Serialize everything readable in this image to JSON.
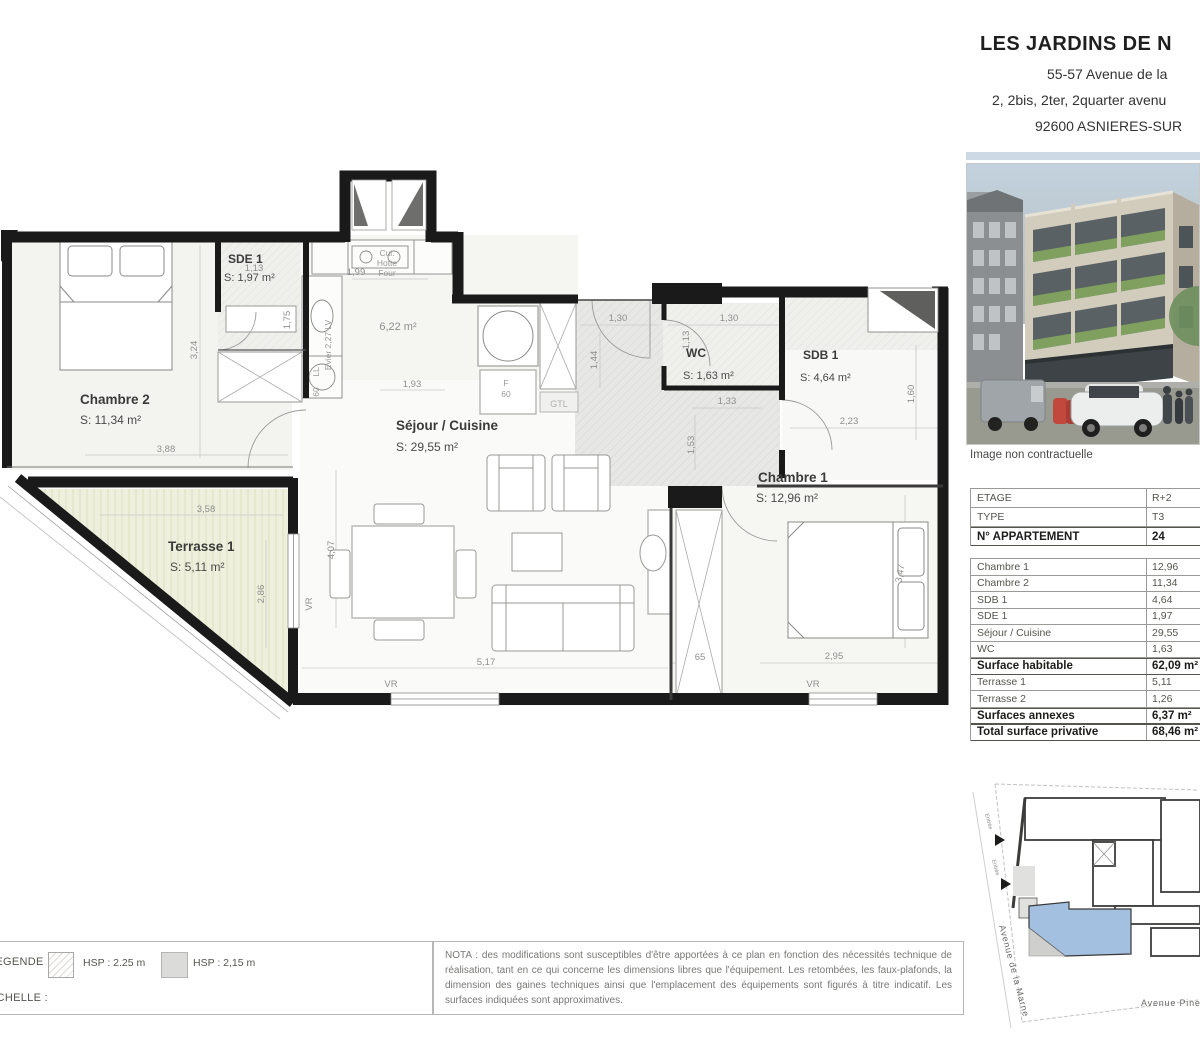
{
  "header": {
    "title": "LES JARDINS DE N",
    "line1": "55-57 Avenue de la",
    "line2": "2, 2bis, 2ter, 2quarter avenu",
    "line3": "92600 ASNIERES-SUR"
  },
  "photo": {
    "caption": "Image non contractuelle"
  },
  "table": {
    "rows": [
      {
        "label": "ETAGE",
        "value": "R+2"
      },
      {
        "label": "TYPE",
        "value": "T3"
      },
      {
        "label": "N° APPARTEMENT",
        "value": "24"
      },
      {
        "label": "Chambre 1",
        "value": "12,96"
      },
      {
        "label": "Chambre 2",
        "value": "11,34"
      },
      {
        "label": "SDB 1",
        "value": "4,64"
      },
      {
        "label": "SDE 1",
        "value": "1,97"
      },
      {
        "label": "Séjour / Cuisine",
        "value": "29,55"
      },
      {
        "label": "WC",
        "value": "1,63"
      },
      {
        "label": "Surface habitable",
        "value": "62,09 m²"
      },
      {
        "label": "Terrasse 1",
        "value": "5,11"
      },
      {
        "label": "Terrasse 2",
        "value": "1,26"
      },
      {
        "label": "Surfaces annexes",
        "value": "6,37 m²"
      },
      {
        "label": "Total surface privative",
        "value": "68,46 m²"
      }
    ]
  },
  "plan": {
    "rooms": {
      "chambre2": {
        "name": "Chambre 2",
        "area": "S: 11,34 m²"
      },
      "sde1": {
        "name": "SDE 1",
        "area": "S: 1,97 m²"
      },
      "sejour": {
        "name": "Séjour / Cuisine",
        "area": "S: 29,55 m²"
      },
      "wc": {
        "name": "WC",
        "area": "S: 1,63 m²"
      },
      "sdb1": {
        "name": "SDB 1",
        "area": "S: 4,64 m²"
      },
      "chambre1": {
        "name": "Chambre 1",
        "area": "S: 12,96 m²"
      },
      "terrasse1": {
        "name": "Terrasse 1",
        "area": "S:  5,11 m²"
      },
      "kitchen_area": "6,22 m²"
    },
    "kitchen": {
      "cui": "Cui.",
      "hotte": "Hotte",
      "four": "Four",
      "evier": "Evier 2,27 LV",
      "ll": "LL",
      "ll_60": "60",
      "f": "F",
      "f_60": "60",
      "gtl": "GTL"
    },
    "dims": {
      "d113a": "1,13",
      "d175": "1,75",
      "d199": "1,99",
      "d324": "3,24",
      "d193": "1,93",
      "d130a": "1,30",
      "d130b": "1,30",
      "d144": "1,44",
      "d113b": "1,13",
      "d133": "1,33",
      "d153": "1,53",
      "d223": "2,23",
      "d160": "1,60",
      "d388": "3,88",
      "d358": "3,58",
      "d286": "2,86",
      "d407": "4,07",
      "d517": "5,17",
      "d65": "65",
      "d295": "2,95",
      "d347": "3,47"
    },
    "vr": "VR"
  },
  "legend": {
    "title": "LEGENDE :",
    "hsp1": "HSP : 2.25 m",
    "hsp2": "HSP : 2,15 m",
    "scale_label": "ECHELLE :"
  },
  "nota": "NOTA : des modifications sont susceptibles d'être apportées à ce plan en fonction des nécessités technique de réalisation, tant en ce qui concerne les dimensions libres que l'équipement. Les retombées, les faux-plafonds, la dimension des gaines techniques ainsi que l'emplacement des équipements sont figurés à titre indicatif. Les surfaces indiquées sont approximatives.",
  "siteplan": {
    "street_left": "Avenue de la Marne",
    "street_bottom": "Avenue Pine",
    "entry1": "Entrée",
    "entry2": "Entrée"
  },
  "colors": {
    "wall": "#1a1a1a",
    "terrace_fill": "#eef0dd",
    "unit_highlight": "#a4c0e0"
  }
}
